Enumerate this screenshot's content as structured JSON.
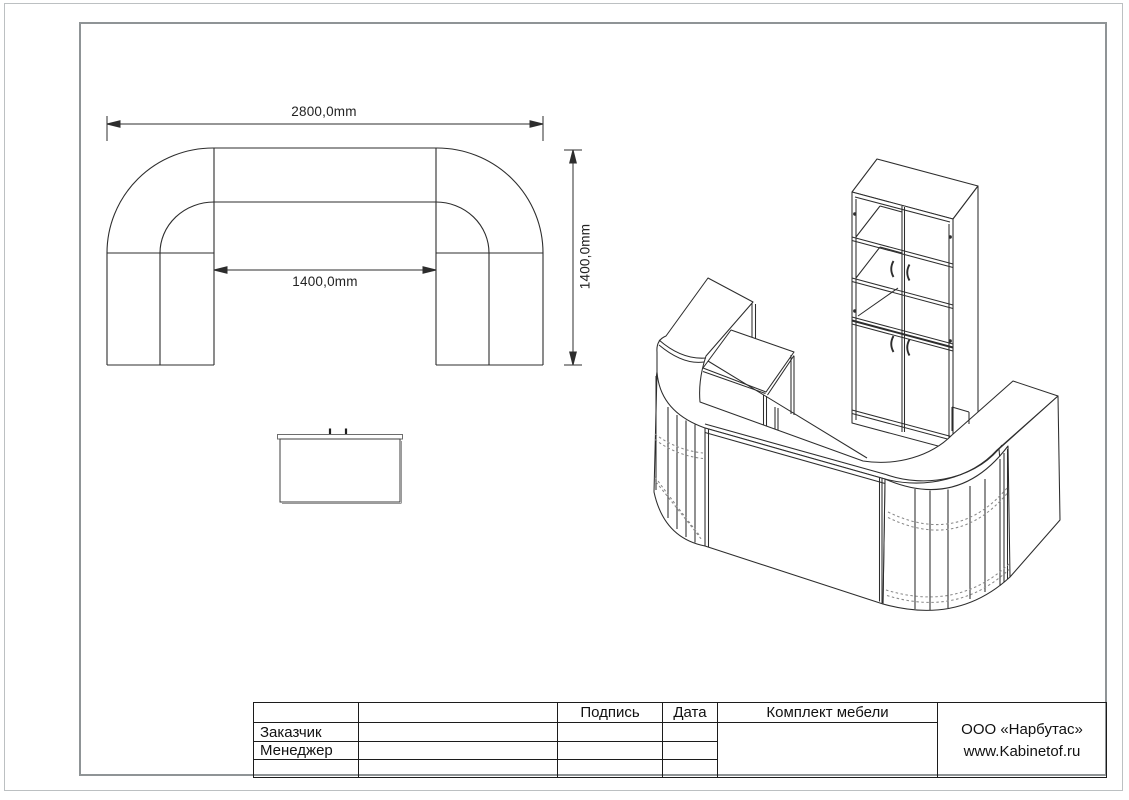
{
  "page": {
    "background": "#ffffff",
    "line_color": "#2d2d2d",
    "frame_color": "#8f9496"
  },
  "plan_view": {
    "dimensions": {
      "overall_width": "2800,0mm",
      "overall_depth": "1400,0mm",
      "inner_width": "1400,0mm"
    }
  },
  "views": {
    "plan": "reception-desk-top-view",
    "front": "reception-desk-front-view",
    "iso": "reception-desk-and-cabinet-isometric-view"
  },
  "title_block": {
    "labels": {
      "customer": "Заказчик",
      "manager": "Менеджер"
    },
    "headers": {
      "signature": "Подпись",
      "date": "Дата",
      "set_name": "Комплект мебели"
    },
    "company": {
      "name": "ООО «Нарбутас»",
      "website": "www.Kabinetof.ru"
    }
  }
}
